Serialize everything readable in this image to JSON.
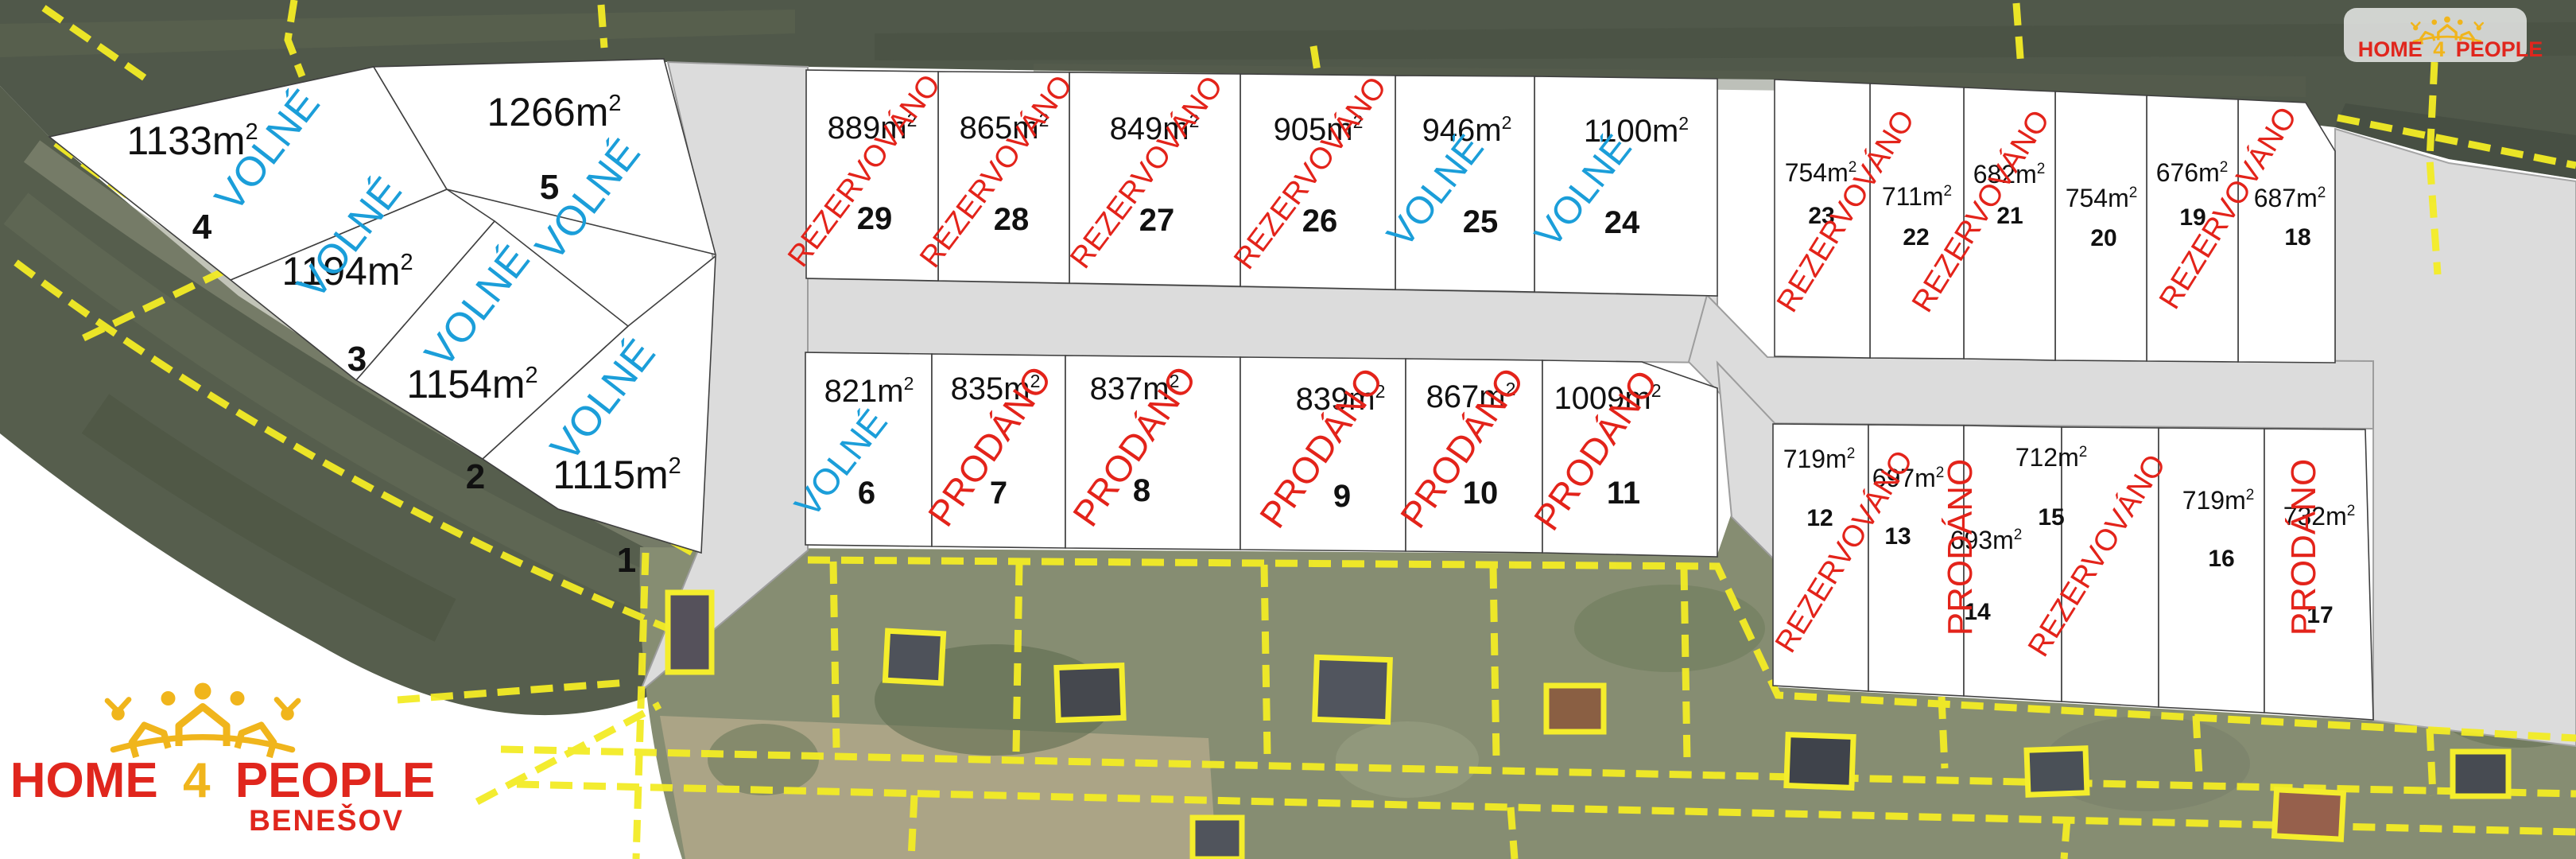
{
  "branding": {
    "main_logo": {
      "word1": "HOME",
      "number": "4",
      "word2": "PEOPLE",
      "subtitle": "BENEŠOV"
    },
    "corner_logo": {
      "word1": "HOME",
      "number": "4",
      "word2": "PEOPLE"
    },
    "watermark": "HOME 4 PEOPLE",
    "colors": {
      "logo_red": "#e0261d",
      "logo_gold": "#f0b51c"
    }
  },
  "map": {
    "area_unit": "m²",
    "status_colors": {
      "VOLNÉ": "#1b9ed9",
      "REZERVOVÁNO": "#e3231a",
      "PRODÁNO": "#e3231a"
    },
    "plots": [
      {
        "number": 1,
        "area_m2": 1115,
        "status": "VOLNÉ",
        "status_shared": false
      },
      {
        "number": 2,
        "area_m2": 1154,
        "status": "VOLNÉ",
        "status_shared": false
      },
      {
        "number": 3,
        "area_m2": 1194,
        "status": "VOLNÉ",
        "status_shared": false
      },
      {
        "number": 4,
        "area_m2": 1133,
        "status": "VOLNÉ",
        "status_shared": false
      },
      {
        "number": 5,
        "area_m2": 1266,
        "status": "VOLNÉ",
        "status_shared": false
      },
      {
        "number": 6,
        "area_m2": 821,
        "status": "VOLNÉ",
        "status_shared": false
      },
      {
        "number": 7,
        "area_m2": 835,
        "status": "PRODÁNO",
        "status_shared": false
      },
      {
        "number": 8,
        "area_m2": 837,
        "status": "PRODÁNO",
        "status_shared": false
      },
      {
        "number": 9,
        "area_m2": 839,
        "status": "PRODÁNO",
        "status_shared": false
      },
      {
        "number": 10,
        "area_m2": 867,
        "status": "PRODÁNO",
        "status_shared": false
      },
      {
        "number": 11,
        "area_m2": 1009,
        "status": "PRODÁNO",
        "status_shared": false
      },
      {
        "number": 12,
        "area_m2": 719,
        "status": "REZERVOVÁNO",
        "status_shared": true
      },
      {
        "number": 13,
        "area_m2": 697,
        "status": "REZERVOVÁNO",
        "status_shared": true
      },
      {
        "number": 14,
        "area_m2": 693,
        "status": "PRODÁNO",
        "status_shared": false
      },
      {
        "number": 15,
        "area_m2": 712,
        "status": "REZERVOVÁNO",
        "status_shared": true
      },
      {
        "number": 16,
        "area_m2": 719,
        "status": "REZERVOVÁNO",
        "status_shared": true
      },
      {
        "number": 17,
        "area_m2": 732,
        "status": "PRODÁNO",
        "status_shared": false
      },
      {
        "number": 18,
        "area_m2": 687,
        "status": "REZERVOVÁNO",
        "status_shared": true
      },
      {
        "number": 19,
        "area_m2": 676,
        "status": "REZERVOVÁNO",
        "status_shared": true
      },
      {
        "number": 20,
        "area_m2": 754,
        "status": "REZERVOVÁNO",
        "status_shared": true
      },
      {
        "number": 21,
        "area_m2": 682,
        "status": "REZERVOVÁNO",
        "status_shared": true
      },
      {
        "number": 22,
        "area_m2": 711,
        "status": "REZERVOVÁNO",
        "status_shared": true
      },
      {
        "number": 23,
        "area_m2": 754,
        "status": "REZERVOVÁNO",
        "status_shared": true
      },
      {
        "number": 24,
        "area_m2": 1100,
        "status": "VOLNÉ",
        "status_shared": false
      },
      {
        "number": 25,
        "area_m2": 946,
        "status": "VOLNÉ",
        "status_shared": false
      },
      {
        "number": 26,
        "area_m2": 905,
        "status": "REZERVOVÁNO",
        "status_shared": false
      },
      {
        "number": 27,
        "area_m2": 849,
        "status": "REZERVOVÁNO",
        "status_shared": false
      },
      {
        "number": 28,
        "area_m2": 865,
        "status": "REZERVOVÁNO",
        "status_shared": false
      },
      {
        "number": 29,
        "area_m2": 889,
        "status": "REZERVOVÁNO",
        "status_shared": false
      }
    ],
    "shared_status_labels": [
      {
        "label": "REZERVOVÁNO",
        "plots": [
          23,
          22
        ]
      },
      {
        "label": "REZERVOVÁNO",
        "plots": [
          21,
          20
        ]
      },
      {
        "label": "REZERVOVÁNO",
        "plots": [
          19,
          18
        ]
      },
      {
        "label": "REZERVOVÁNO",
        "plots": [
          12,
          13
        ]
      },
      {
        "label": "REZERVOVÁNO",
        "plots": [
          15,
          16
        ]
      }
    ]
  }
}
